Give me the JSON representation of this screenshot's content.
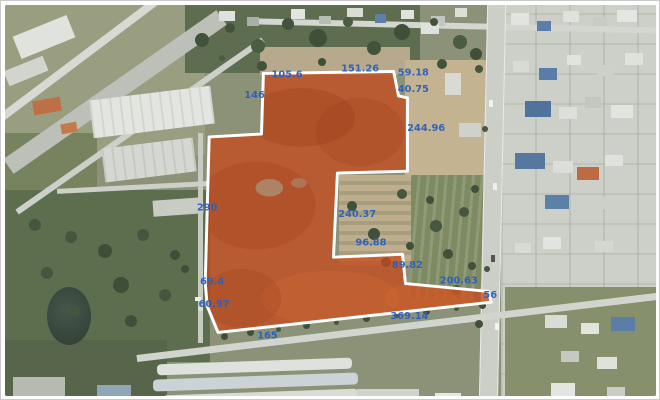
{
  "view": {
    "type": "satellite-parcel-measurement-view",
    "frame_color": "#ffffff"
  },
  "parcel": {
    "fill_color": "#c8481a",
    "fill_opacity": 0.74,
    "outline_color": "#ffffff",
    "outline_width": 3,
    "points": [
      [
        262,
        70
      ],
      [
        394,
        68
      ],
      [
        399,
        93
      ],
      [
        408,
        95
      ],
      [
        408,
        170
      ],
      [
        337,
        172
      ],
      [
        333,
        258
      ],
      [
        403,
        255
      ],
      [
        406,
        285
      ],
      [
        490,
        293
      ],
      [
        493,
        304
      ],
      [
        216,
        335
      ],
      [
        205,
        308
      ],
      [
        203,
        284
      ],
      [
        207,
        135
      ],
      [
        260,
        132
      ]
    ]
  },
  "measurements": {
    "color": "#2a5fc0",
    "labels": [
      {
        "text": "105.6",
        "x": 286,
        "y": 74
      },
      {
        "text": "151.26",
        "x": 360,
        "y": 68
      },
      {
        "text": "59.18",
        "x": 414,
        "y": 72
      },
      {
        "text": "40.75",
        "x": 414,
        "y": 89
      },
      {
        "text": "146",
        "x": 253,
        "y": 95
      },
      {
        "text": "244.96",
        "x": 427,
        "y": 129
      },
      {
        "text": "290",
        "x": 205,
        "y": 210
      },
      {
        "text": "240.37",
        "x": 357,
        "y": 217
      },
      {
        "text": "96.88",
        "x": 371,
        "y": 246
      },
      {
        "text": "89.82",
        "x": 408,
        "y": 269
      },
      {
        "text": "200.63",
        "x": 460,
        "y": 285
      },
      {
        "text": "56",
        "x": 492,
        "y": 300
      },
      {
        "text": "69.4",
        "x": 210,
        "y": 286
      },
      {
        "text": "60.97",
        "x": 212,
        "y": 309
      },
      {
        "text": "165",
        "x": 266,
        "y": 341
      },
      {
        "text": "369.14",
        "x": 410,
        "y": 321
      }
    ]
  }
}
